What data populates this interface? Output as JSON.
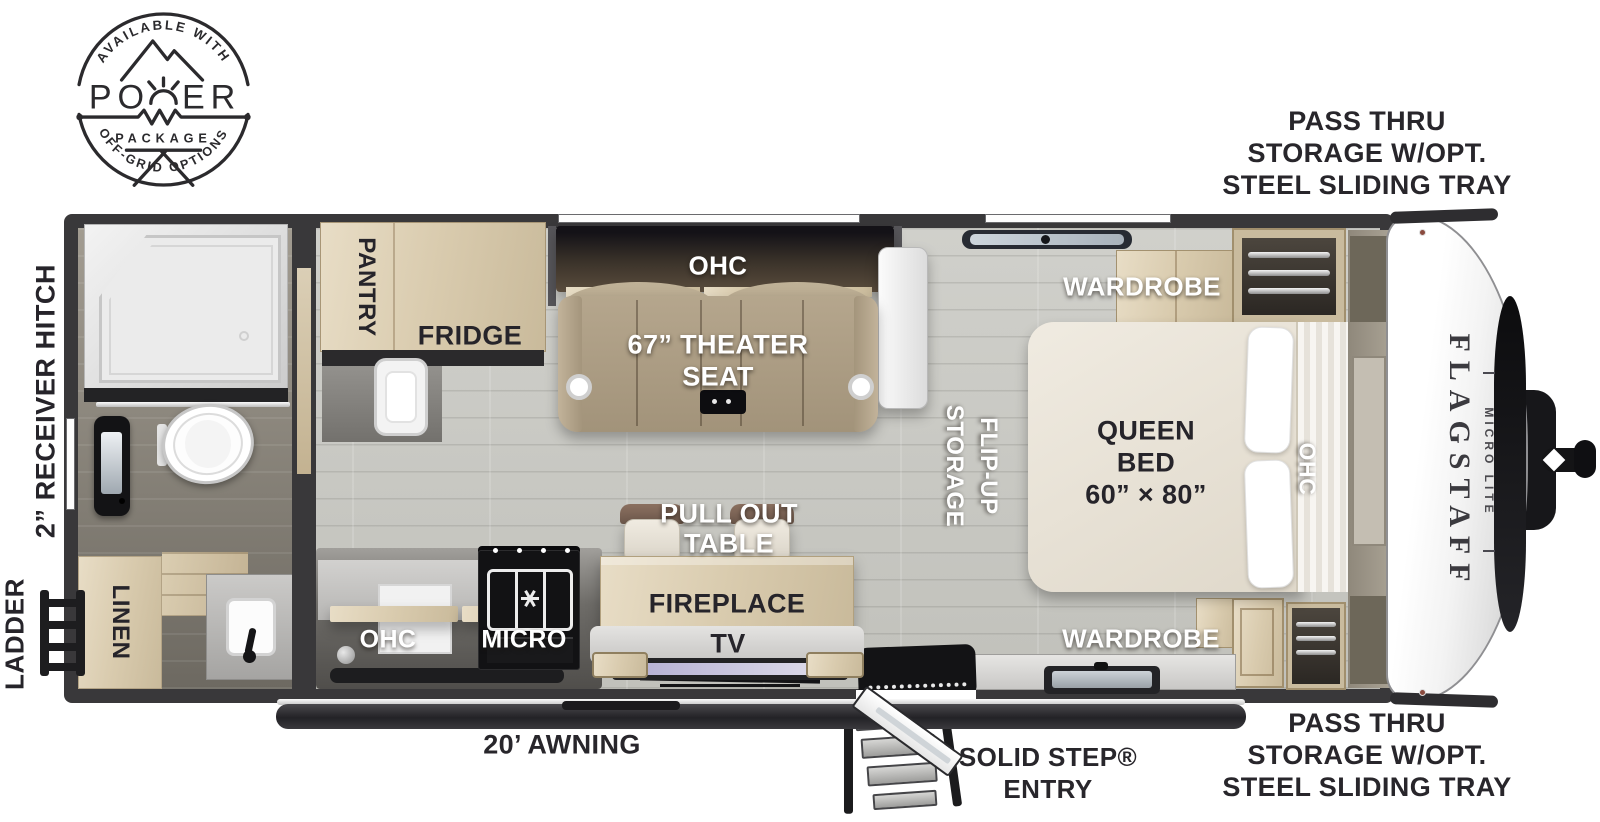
{
  "badge": {
    "arc_top": "AVAILABLE WITH",
    "power_left": "PO",
    "power_right": "ER",
    "package": "PACKAGE",
    "arc_bottom": "OFF-GRID OPTIONS"
  },
  "callouts": {
    "pass_thru_top": {
      "line1": "PASS THRU",
      "line2": "STORAGE W/OPT.",
      "line3": "STEEL SLIDING TRAY"
    },
    "pass_thru_bottom": {
      "line1": "PASS THRU",
      "line2": "STORAGE W/OPT.",
      "line3": "STEEL SLIDING TRAY"
    },
    "receiver_hitch": "2” RECEIVER HITCH",
    "ladder": "LADDER",
    "awning": "20’ AWNING",
    "solid_step": {
      "line1": "SOLID STEP®",
      "line2": "ENTRY"
    }
  },
  "interior": {
    "pantry": "PANTRY",
    "fridge": "FRIDGE",
    "ohc_living": "OHC",
    "theater": {
      "line1": "67” THEATER",
      "line2": "SEAT"
    },
    "flip_up": {
      "line1": "FLIP-UP",
      "line2": "STORAGE"
    },
    "wardrobe_top": "WARDROBE",
    "wardrobe_bottom": "WARDROBE",
    "queen_bed": {
      "line1": "QUEEN",
      "line2": "BED",
      "line3": "60” × 80”"
    },
    "ohc_bed": "OHC",
    "pull_out_table": {
      "line1": "PULL OUT",
      "line2": "TABLE"
    },
    "fireplace": "FIREPLACE",
    "tv": "TV",
    "ohc_kitchen": "OHC",
    "micro": "MICRO",
    "linen": "LINEN"
  },
  "brand": {
    "name": "FLAGSTAFF",
    "series": "MICRO LITE"
  },
  "colors": {
    "wall": "#39383a",
    "wood": "#dccfb5",
    "seat_tan": "#b2a38a",
    "label_ink": "#28262b",
    "floor": "#c9c9c4"
  }
}
